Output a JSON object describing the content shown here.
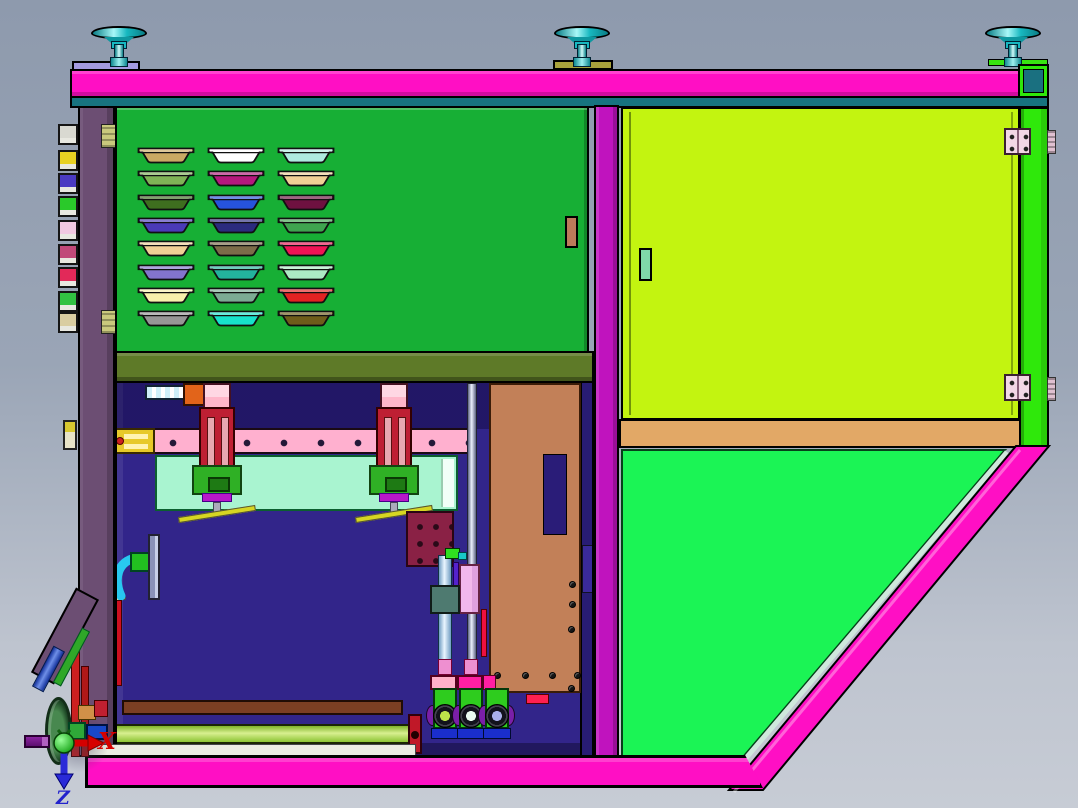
{
  "scene": {
    "view": "CAD assembly side view",
    "axis_triad": {
      "x_label": "X",
      "z_label": "Z"
    }
  },
  "palette": {
    "bg_top": "#8E9AAD",
    "bg_bottom": "#C7CCD5",
    "frame_magenta": "#FF0FC4",
    "column_magenta": "#C013BE",
    "teal_strip": "#17737F",
    "purple_column": "#6C4E73",
    "tray_panel_green": "#17AF35",
    "door_chartreuse": "#C3F410",
    "right_strip_green": "#2FE80B",
    "lower_panel_green": "#1BF455",
    "tan_strip": "#E2A866",
    "olive_beam": "#5E7A28",
    "interior_navy": "#32258A",
    "interior_navy_strip": "#281C74",
    "rail_pink": "#FFB0CF",
    "rail_bracket_yellow": "#E7C929",
    "slide_red": "#BE1F33",
    "slide_pink": "#FFB6C9",
    "slide_pink_light": "#FFD7E3",
    "bracket_green": "#2FB025",
    "bracket_green_dark": "#1E7A14",
    "wedge_magenta": "#B818C8",
    "mint_panel": "#A9F4D0",
    "inner_tan": "#C28058",
    "maroon_plate": "#8A2145",
    "hook_cyan": "#28C8F0",
    "brown_bar": "#7B3F23",
    "unit_green": "#2ECC1E",
    "unit_blue": "#1A2ECC",
    "disc_purple": "#7A1FA8",
    "cap_pink": "#FFB0C9",
    "cap_magenta": "#FF1FA3",
    "foot_cyan": "#17B8C0",
    "pad_lavender": "#A49BE0",
    "pad_olive": "#A8A23C",
    "pad_green": "#37E211",
    "handle_green": "#7FD8A8",
    "hinge_pink": "#F2D7E6",
    "axis_red": "#D50000",
    "axis_blue": "#2A2AD8",
    "axis_green": "#2EDC2E"
  },
  "tray_panel": {
    "rows": [
      [
        "#C9A963",
        "#FFFFFF",
        "#AEEADF"
      ],
      [
        "#7FB356",
        "#B5187E",
        "#F0D095"
      ],
      [
        "#3E6E1F",
        "#2653DC",
        "#6E1140"
      ],
      [
        "#4A3AB8",
        "#2B2B7E",
        "#3FA44F"
      ],
      [
        "#F0D095",
        "#7C6C49",
        "#F01355"
      ],
      [
        "#8374CD",
        "#23B39D",
        "#ACEAC4"
      ],
      [
        "#F7F0AB",
        "#7CAB93",
        "#E32222"
      ],
      [
        "#969696",
        "#17E2CB",
        "#6E5D1A"
      ]
    ]
  },
  "left_column": {
    "clip_colors": [
      "#D9D9D1",
      "#E8D122",
      "#4A3AC2",
      "#2AC92A",
      "#F1C9E1",
      "#C14979",
      "#E22959",
      "#32C242",
      "#D9CDA1"
    ]
  },
  "roller_units": {
    "bearing_colors": [
      "#BEE24A",
      "#EAFBF2",
      "#A9AFE9"
    ]
  }
}
